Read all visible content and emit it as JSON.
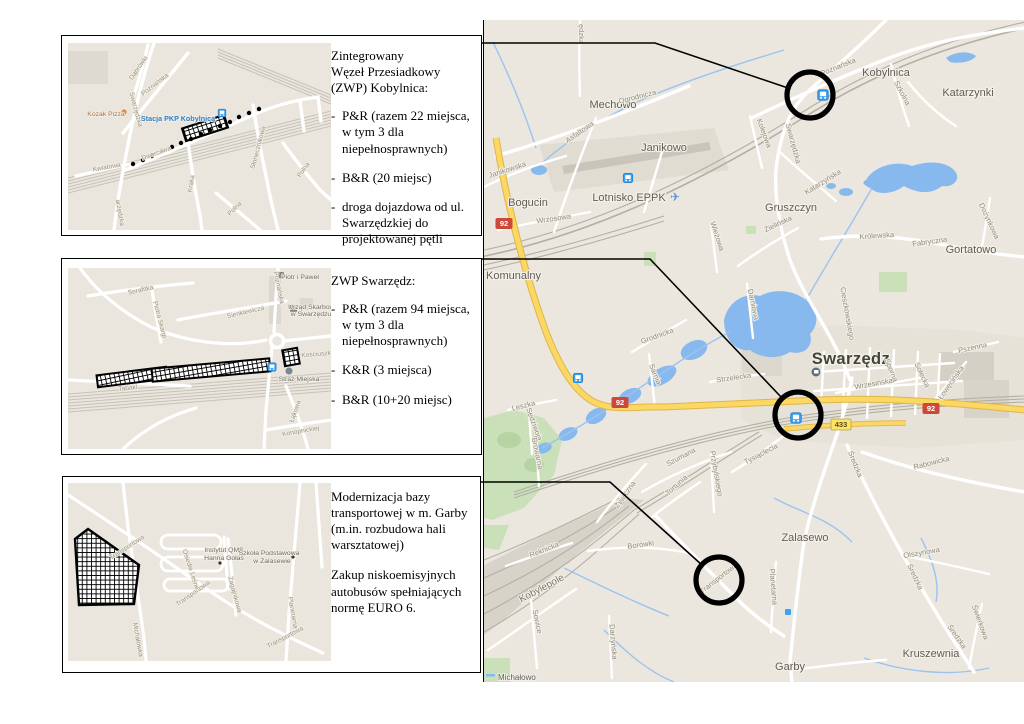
{
  "panels": [
    {
      "id": "kobylnica",
      "title_lines": [
        "Zintegrowany",
        "Węzeł Przesiadkowy",
        "(ZWP) Kobylnica:"
      ],
      "bullets": [
        "P&R (razem 22 miejsca, w tym 3 dla niepełnosprawnych)",
        "B&R (20 miejsc)",
        "droga dojazdowa od ul. Swarzędzkiej do projektowanej pętli"
      ],
      "map": {
        "labels": [
          {
            "t": "Dąbrówki",
            "x": 72,
            "y": 26,
            "r": -55,
            "c": "istreet"
          },
          {
            "t": "Poznańska",
            "x": 88,
            "y": 43,
            "r": -38,
            "c": "istreet"
          },
          {
            "t": "Swarzędzka",
            "x": 66,
            "y": 67,
            "r": 75,
            "c": "istreet"
          },
          {
            "t": "arzędzka",
            "x": 50,
            "y": 170,
            "r": 80,
            "c": "istreet"
          },
          {
            "t": "Kwiatowa",
            "x": 39,
            "y": 126,
            "r": -10,
            "c": "istreet"
          },
          {
            "t": "Dworcowa",
            "x": 89,
            "y": 112,
            "r": -20,
            "c": "istreet"
          },
          {
            "t": "Kraka",
            "x": 125,
            "y": 141,
            "r": -80,
            "c": "istreet"
          },
          {
            "t": "Słonecznikowa",
            "x": 192,
            "y": 105,
            "r": -75,
            "c": "istreet"
          },
          {
            "t": "Polna",
            "x": 237,
            "y": 128,
            "r": -55,
            "c": "istreet"
          },
          {
            "t": "Polna",
            "x": 168,
            "y": 167,
            "r": -45,
            "c": "istreet"
          },
          {
            "t": "Kozak Pizza",
            "x": 38,
            "y": 73,
            "r": 0,
            "c": "ipoi-orange"
          },
          {
            "t": "Stacja PKP Kobylnica",
            "x": 110,
            "y": 78,
            "r": 0,
            "c": "istation"
          }
        ]
      }
    },
    {
      "id": "swarzedz",
      "title_lines": [
        "ZWP Swarzędz:"
      ],
      "bullets": [
        "P&R (razem 94 miejsca, w tym 3 dla niepełnosprawnych)",
        "K&R (3 miejsca)",
        "B&R (10+20 miejsc)"
      ],
      "map": {
        "labels": [
          {
            "t": "Serafitka",
            "x": 73,
            "y": 24,
            "r": -13,
            "c": "istreet"
          },
          {
            "t": "Sienkiewicza",
            "x": 178,
            "y": 46,
            "r": -13,
            "c": "istreet"
          },
          {
            "t": "Piotra Skargi",
            "x": 90,
            "y": 52,
            "r": 75,
            "c": "istreet"
          },
          {
            "t": "Poznańska",
            "x": 209,
            "y": 20,
            "r": 78,
            "c": "istreet"
          },
          {
            "t": "Tabaki",
            "x": 60,
            "y": 122,
            "r": -6,
            "c": "istreet"
          },
          {
            "t": "Łąkowa",
            "x": 229,
            "y": 144,
            "r": -70,
            "c": "istreet"
          },
          {
            "t": "Konopnickiej",
            "x": 233,
            "y": 165,
            "r": -10,
            "c": "istreet"
          },
          {
            "t": "Kościuszki",
            "x": 249,
            "y": 88,
            "r": -5,
            "c": "istreet"
          },
          {
            "t": "Piotr i Paweł",
            "x": 232,
            "y": 11,
            "r": 0,
            "c": "ipoi"
          },
          {
            "t": "Urząd Skarbowy",
            "x": 245,
            "y": 41,
            "r": 0,
            "c": "ipoi"
          },
          {
            "t": "w Swarzędzu",
            "x": 243,
            "y": 48,
            "r": 0,
            "c": "ipoi"
          },
          {
            "t": "Straż Miejska",
            "x": 231,
            "y": 113,
            "r": 0,
            "c": "ipoi"
          }
        ]
      }
    },
    {
      "id": "garby",
      "paragraphs": [
        "Modernizacja bazy transportowej w m. Garby (m.in. rozbudowa hali warsztatowej)",
        "Zakup niskoemisyjnych autobusów spełniających normę EURO 6."
      ],
      "map": {
        "labels": [
          {
            "t": "Transportowa",
            "x": 60,
            "y": 66,
            "r": -33,
            "c": "istreet"
          },
          {
            "t": "Transportowa",
            "x": 126,
            "y": 112,
            "r": -35,
            "c": "istreet"
          },
          {
            "t": "Transportowa",
            "x": 218,
            "y": 156,
            "r": -28,
            "c": "istreet"
          },
          {
            "t": "Michałówka",
            "x": 68,
            "y": 157,
            "r": 80,
            "c": "istreet"
          },
          {
            "t": "Osiedle Leśne",
            "x": 121,
            "y": 87,
            "r": 72,
            "c": "istreet"
          },
          {
            "t": "Zagajnikowa",
            "x": 165,
            "y": 112,
            "r": 75,
            "c": "istreet"
          },
          {
            "t": "Planetarna",
            "x": 223,
            "y": 130,
            "r": 80,
            "c": "istreet"
          },
          {
            "t": "Instytut QMS",
            "x": 156,
            "y": 69,
            "r": 0,
            "c": "ipoi"
          },
          {
            "t": "Hanna Gołaś",
            "x": 156,
            "y": 77,
            "r": 0,
            "c": "ipoi"
          },
          {
            "t": "Szkoła Podstawowa",
            "x": 201,
            "y": 72,
            "r": 0,
            "c": "ipoi"
          },
          {
            "t": "w Zalasewie",
            "x": 204,
            "y": 80,
            "r": 0,
            "c": "ipoi"
          }
        ]
      }
    }
  ],
  "big_map": {
    "labels": [
      {
        "t": "Mechowo",
        "x": 129,
        "y": 88,
        "r": 0,
        "c": "town"
      },
      {
        "t": "Janikowo",
        "x": 180,
        "y": 131,
        "r": 0,
        "c": "town"
      },
      {
        "t": "Bogucin",
        "x": 44,
        "y": 186,
        "r": 0,
        "c": "town"
      },
      {
        "t": "Lotnisko EPPK",
        "x": 145,
        "y": 181,
        "r": 0,
        "c": "town"
      },
      {
        "t": "Kobylnica",
        "x": 402,
        "y": 56,
        "r": 0,
        "c": "town"
      },
      {
        "t": "Katarzynki",
        "x": 484,
        "y": 76,
        "r": 0,
        "c": "town"
      },
      {
        "t": "Gruszczyn",
        "x": 307,
        "y": 191,
        "r": 0,
        "c": "town"
      },
      {
        "t": "Gortatowo",
        "x": 487,
        "y": 233,
        "r": 0,
        "c": "town"
      },
      {
        "t": "Swarzędz",
        "x": 367,
        "y": 344,
        "r": 0,
        "c": "city"
      },
      {
        "t": "Zalasewo",
        "x": 321,
        "y": 521,
        "r": 0,
        "c": "town"
      },
      {
        "t": "Garby",
        "x": 306,
        "y": 650,
        "r": 0,
        "c": "town"
      },
      {
        "t": "Kruszewnia",
        "x": 447,
        "y": 637,
        "r": 0,
        "c": "town"
      },
      {
        "t": "Kobylepole",
        "x": 59,
        "y": 571,
        "r": -28,
        "c": "district"
      },
      {
        "t": "Michałowo",
        "x": 14,
        "y": 660,
        "r": 0,
        "c": "smalltown"
      },
      {
        "t": "Komunalny",
        "x": 2,
        "y": 259,
        "r": 0,
        "c": "townL"
      },
      {
        "t": "ędzka",
        "x": 95,
        "y": 14,
        "r": 90,
        "c": "street"
      },
      {
        "t": "Ogrodnicza",
        "x": 154,
        "y": 79,
        "r": -14,
        "c": "street"
      },
      {
        "t": "Asfaltowa",
        "x": 97,
        "y": 114,
        "r": -35,
        "c": "street"
      },
      {
        "t": "Janikowska",
        "x": 24,
        "y": 152,
        "r": -18,
        "c": "street"
      },
      {
        "t": "Wrzosowa",
        "x": 70,
        "y": 201,
        "r": -8,
        "c": "street"
      },
      {
        "t": "Poznańska",
        "x": 355,
        "y": 49,
        "r": -22,
        "c": "street"
      },
      {
        "t": "Szkolna",
        "x": 416,
        "y": 74,
        "r": 62,
        "c": "street"
      },
      {
        "t": "Swarzędzka",
        "x": 307,
        "y": 124,
        "r": 75,
        "c": "street"
      },
      {
        "t": "Kolejowa",
        "x": 278,
        "y": 114,
        "r": 70,
        "c": "street"
      },
      {
        "t": "Katarzyńska",
        "x": 340,
        "y": 164,
        "r": -32,
        "c": "street"
      },
      {
        "t": "Zielińska",
        "x": 295,
        "y": 206,
        "r": -25,
        "c": "street"
      },
      {
        "t": "Królewska",
        "x": 393,
        "y": 218,
        "r": -4,
        "c": "street"
      },
      {
        "t": "Fabryczna",
        "x": 446,
        "y": 224,
        "r": -8,
        "c": "street"
      },
      {
        "t": "Dożynkowa",
        "x": 503,
        "y": 202,
        "r": 65,
        "c": "street"
      },
      {
        "t": "Wieżowa",
        "x": 231,
        "y": 217,
        "r": 72,
        "c": "street"
      },
      {
        "t": "Darniowa",
        "x": 267,
        "y": 285,
        "r": 78,
        "c": "street"
      },
      {
        "t": "Cieszkowskiego",
        "x": 361,
        "y": 294,
        "r": 80,
        "c": "street"
      },
      {
        "t": "Grodnicka",
        "x": 174,
        "y": 318,
        "r": -20,
        "c": "street"
      },
      {
        "t": "Sarnia",
        "x": 169,
        "y": 355,
        "r": 68,
        "c": "street"
      },
      {
        "t": "Strzelecka",
        "x": 250,
        "y": 360,
        "r": -8,
        "c": "street"
      },
      {
        "t": "Leszka",
        "x": 40,
        "y": 388,
        "r": -14,
        "c": "street"
      },
      {
        "t": "Sędziwoja",
        "x": 48,
        "y": 405,
        "r": 70,
        "c": "street"
      },
      {
        "t": "Browarna",
        "x": 51,
        "y": 434,
        "r": 78,
        "c": "street"
      },
      {
        "t": "Wrzesińska",
        "x": 390,
        "y": 366,
        "r": -10,
        "c": "street"
      },
      {
        "t": "Sporna",
        "x": 405,
        "y": 351,
        "r": 68,
        "c": "street"
      },
      {
        "t": "Sołecka",
        "x": 436,
        "y": 356,
        "r": 65,
        "c": "street"
      },
      {
        "t": "Łowęcińska",
        "x": 469,
        "y": 364,
        "r": -55,
        "c": "street"
      },
      {
        "t": "Pszenna",
        "x": 489,
        "y": 330,
        "r": -12,
        "c": "street"
      },
      {
        "t": "Rabowicka",
        "x": 448,
        "y": 445,
        "r": -14,
        "c": "street"
      },
      {
        "t": "Średzka",
        "x": 369,
        "y": 445,
        "r": 68,
        "c": "street"
      },
      {
        "t": "Średzka",
        "x": 429,
        "y": 558,
        "r": 65,
        "c": "street"
      },
      {
        "t": "Średzka",
        "x": 471,
        "y": 618,
        "r": 55,
        "c": "street"
      },
      {
        "t": "Olszynowa",
        "x": 438,
        "y": 535,
        "r": -10,
        "c": "street"
      },
      {
        "t": "Świerkowa",
        "x": 494,
        "y": 603,
        "r": 70,
        "c": "street"
      },
      {
        "t": "Planetarna",
        "x": 287,
        "y": 567,
        "r": 85,
        "c": "street"
      },
      {
        "t": "Tysiąclecia",
        "x": 278,
        "y": 436,
        "r": -28,
        "c": "street"
      },
      {
        "t": "Przybylskiego",
        "x": 230,
        "y": 454,
        "r": 80,
        "c": "street"
      },
      {
        "t": "Szumana",
        "x": 198,
        "y": 439,
        "r": -28,
        "c": "street"
      },
      {
        "t": "Tortunia",
        "x": 194,
        "y": 467,
        "r": -42,
        "c": "street"
      },
      {
        "t": "Żywiczna",
        "x": 143,
        "y": 476,
        "r": -55,
        "c": "street"
      },
      {
        "t": "Borówki",
        "x": 157,
        "y": 527,
        "r": -8,
        "c": "street"
      },
      {
        "t": "Transportowa",
        "x": 236,
        "y": 560,
        "r": -38,
        "c": "street"
      },
      {
        "t": "Reknicka",
        "x": 61,
        "y": 532,
        "r": -22,
        "c": "street"
      },
      {
        "t": "Sowice",
        "x": 51,
        "y": 602,
        "r": 78,
        "c": "street"
      },
      {
        "t": "Darzyńska",
        "x": 127,
        "y": 622,
        "r": 85,
        "c": "street"
      },
      {
        "t": "92",
        "x": 20,
        "y": 206,
        "r": 0,
        "c": "shield92"
      },
      {
        "t": "92",
        "x": 136,
        "y": 385,
        "r": 0,
        "c": "shield92"
      },
      {
        "t": "92",
        "x": 447,
        "y": 391,
        "r": 0,
        "c": "shield92"
      },
      {
        "t": "433",
        "x": 357,
        "y": 407,
        "r": 0,
        "c": "shield433"
      }
    ]
  },
  "colors": {
    "map_bg": "#ebe7df",
    "water": "#87b9ee",
    "green": "#c9e0b8",
    "road_white": "#ffffff",
    "road_yellow": "#fbd763",
    "shield_red": "#cd473a",
    "shield_yellow": "#fce367",
    "rail_gray": "#b3afa5",
    "marker_black": "#000000",
    "station_blue": "#3da2f4"
  }
}
